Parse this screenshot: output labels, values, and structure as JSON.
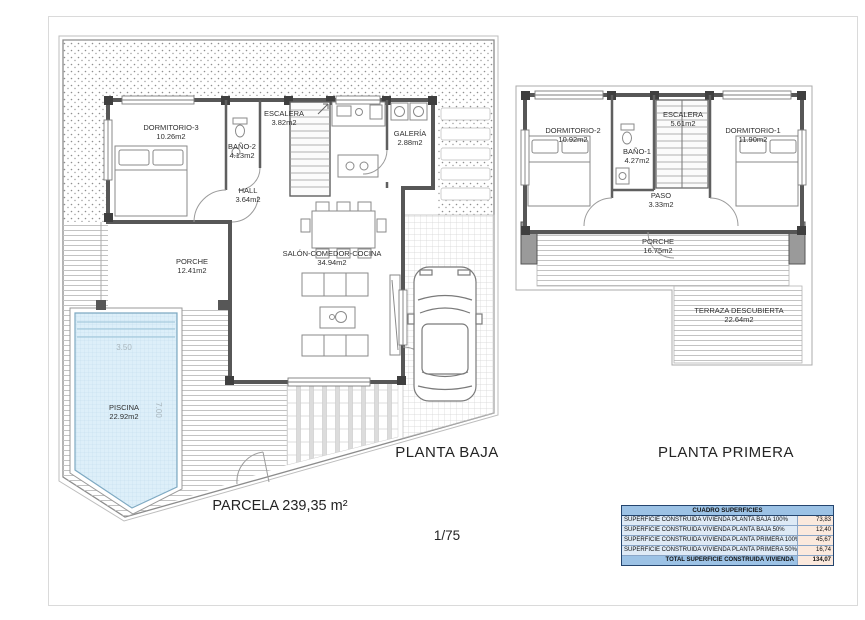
{
  "sheet": {
    "parcel_label": "PARCELA 239,35 m²",
    "scale": "1/75"
  },
  "ground_floor": {
    "title": "PLANTA BAJA",
    "rooms": {
      "dormitorio3": {
        "name": "DORMITORIO-3",
        "area": "10.26m2"
      },
      "bano2": {
        "name": "BAÑO-2",
        "area": "4.13m2"
      },
      "escalera": {
        "name": "ESCALERA",
        "area": "3.82m2"
      },
      "galeria": {
        "name": "GALERÍA",
        "area": "2.88m2"
      },
      "hall": {
        "name": "HALL",
        "area": "3.64m2"
      },
      "salon": {
        "name": "SALÓN-COMEDOR-COCINA",
        "area": "34.94m2"
      },
      "porche": {
        "name": "PORCHE",
        "area": "12.41m2"
      },
      "piscina": {
        "name": "PISCINA",
        "area": "22.92m2"
      }
    },
    "pool_dims": {
      "width": "3.50",
      "length": "7.00"
    }
  },
  "first_floor": {
    "title": "PLANTA PRIMERA",
    "rooms": {
      "dormitorio2": {
        "name": "DORMITORIO-2",
        "area": "10.92m2"
      },
      "bano1": {
        "name": "BAÑO-1",
        "area": "4.27m2"
      },
      "escalera": {
        "name": "ESCALERA",
        "area": "5.61m2"
      },
      "dormitorio1": {
        "name": "DORMITORIO-1",
        "area": "11.90m2"
      },
      "paso": {
        "name": "PASO",
        "area": "3.33m2"
      },
      "porche": {
        "name": "PORCHE",
        "area": "16.75m2"
      },
      "terraza": {
        "name": "TERRAZA DESCUBIERTA",
        "area": "22.64m2"
      }
    }
  },
  "surfaces_table": {
    "title": "CUADRO SUPERFICIES",
    "rows": [
      {
        "label": "SUPERFICIE CONSTRUIDA VIVIENDA PLANTA BAJA 100%",
        "value": "73,83"
      },
      {
        "label": "SUPERFICIE CONSTRUIDA VIVIENDA PLANTA BAJA 50%",
        "value": "12,40"
      },
      {
        "label": "SUPERFICIE CONSTRUIDA VIVIENDA PLANTA PRIMERA 100%",
        "value": "45,67"
      },
      {
        "label": "SUPERFICIE CONSTRUIDA VIVIENDA PLANTA PRIMERA 50%",
        "value": "16,74"
      }
    ],
    "total": {
      "label": "TOTAL SUPERFICIE CONSTRUIDA VIVIENDA",
      "value": "134,07"
    },
    "colors": {
      "header_bg": "#9cc2e5",
      "row_label_bg": "#deeaf6",
      "value_bg": "#fbe9dd",
      "border": "#24456e"
    }
  }
}
